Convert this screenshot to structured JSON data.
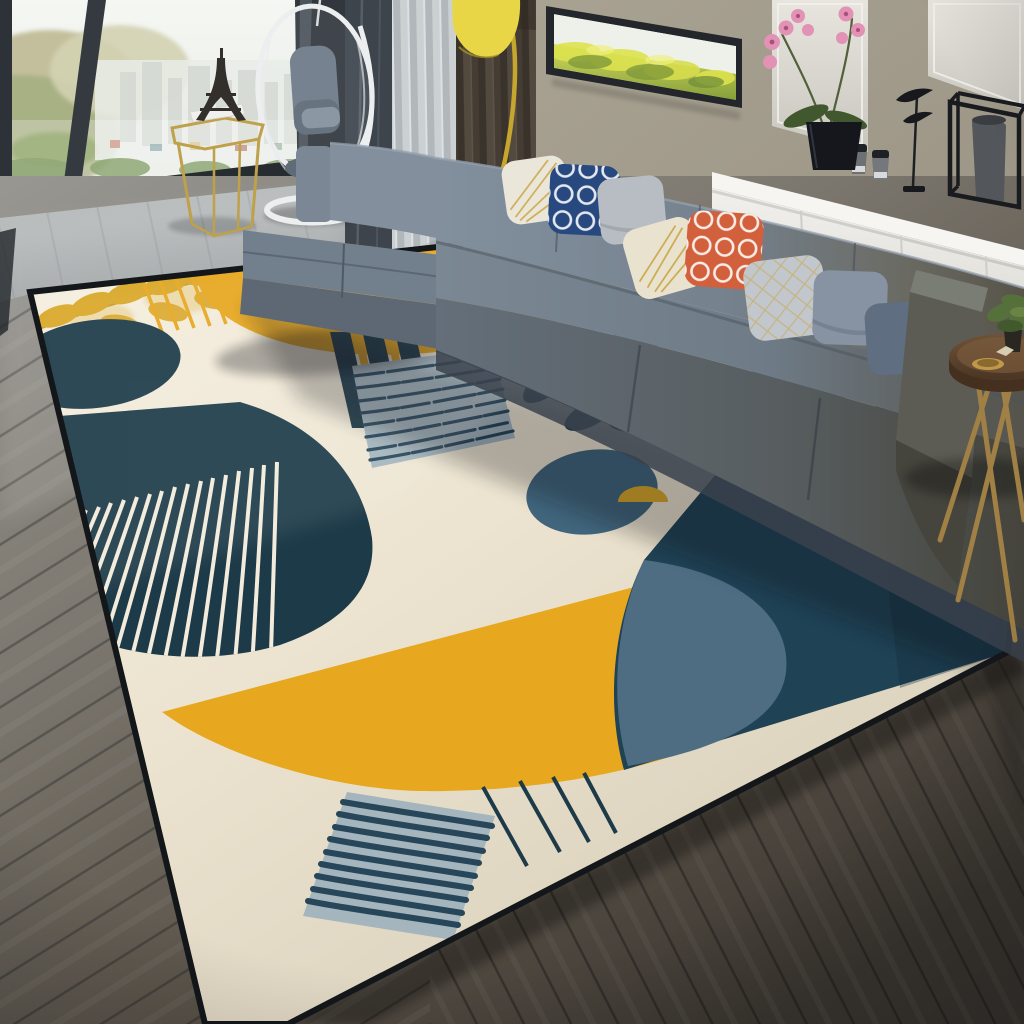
{
  "meta": {
    "alt": "Bright high-rise living room: L-shaped gray fabric sofa with patterned throw pillows, panoramic window with city view, white hanging egg chair, gold side table with Eiffel tower model, yellow floor lamp, white sideboard with orchid and black decor, and a large Nordic geometric area rug (cream, navy, mustard yellow, teal) on gray wood flooring."
  },
  "palette": {
    "rug-cream": "#ece4d1",
    "rug-navy": "#1d3a48",
    "rug-yellow": "#e7a71e",
    "rug-teal": "#1f4255",
    "rug-slate": "#4e6d83",
    "rug-circle": "#40657c",
    "rug-graysq": "#a4b5bd",
    "rug-scrib": "#27465a",
    "rug-leafgold": "#d9a727",
    "rug-white": "#f3ecdc",
    "sofa-back": "#7e8b99",
    "sofa-seat": "#75828e",
    "sofa-front": "#5e6974",
    "sofa-deep": "#454b4e",
    "pillow-white": "#ebe6da",
    "pillow-navy": "#27497f",
    "pillow-gray": "#b8bdc3",
    "pillow-cream": "#e9e2cf",
    "pillow-orange": "#d2603c",
    "pillow-grid": "#c2c7cd",
    "pillow-slate": "#8793a2",
    "pillow-dark": "#5f6e80",
    "gold": "#c9a43e",
    "wall": "#a59f91",
    "curtain-dark": "#473f37",
    "curtain-sheer": "#c6cacd",
    "lamp-yellow": "#e8d647",
    "lamp-arm": "#c7a62d",
    "mirror": "#dcdad3",
    "art-frame": "#23262a",
    "meadow-green": "#9db23f",
    "orchid-pink": "#e192b5",
    "leaf-green": "#41582e",
    "pot-black": "#15171c",
    "sideboard": "#efede9",
    "wood": "#6b4f35",
    "gold-leg": "#a08044",
    "egg-white": "#eceef0",
    "frame-dark": "#2c3237",
    "floor-light": "#b3b6b6",
    "floor-dark": "#3f3a33",
    "shadow": "#10151a"
  },
  "scene": {
    "objects": [
      "panoramic-window",
      "city-view",
      "hanging-egg-chair",
      "gold-side-table",
      "eiffel-tower-model",
      "sheer-curtain",
      "dark-curtain",
      "yellow-floor-lamp",
      "wall-art-meadow",
      "mirror-panels",
      "orchid-plant",
      "white-sideboard",
      "decor-cups",
      "bird-sculpture",
      "cube-frame-vase",
      "l-shaped-sofa",
      "throw-pillows",
      "geometric-area-rug",
      "round-wood-side-table",
      "potted-plant",
      "gray-wood-floor"
    ]
  }
}
